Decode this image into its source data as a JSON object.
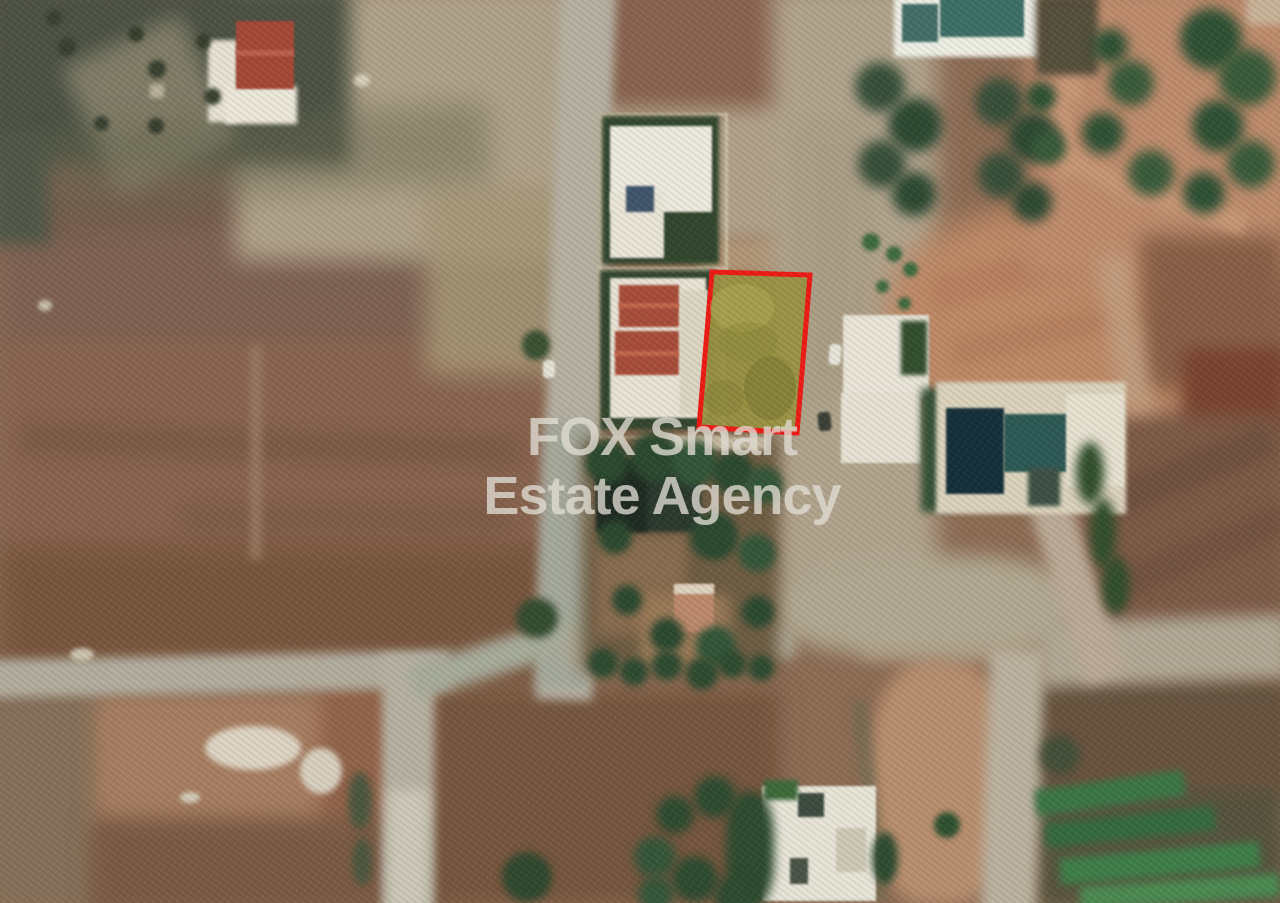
{
  "watermark": {
    "line1": "FOX Smart",
    "line2": "Estate Agency",
    "color": "rgba(224,221,212,0.78)"
  },
  "plot": {
    "polygon_points": "712,272 810,275 797,433 699,427",
    "stroke_color": "#ee1c16",
    "fill_color": "#9b9343",
    "fill_opacity": "0.95",
    "stroke_width": "5"
  }
}
